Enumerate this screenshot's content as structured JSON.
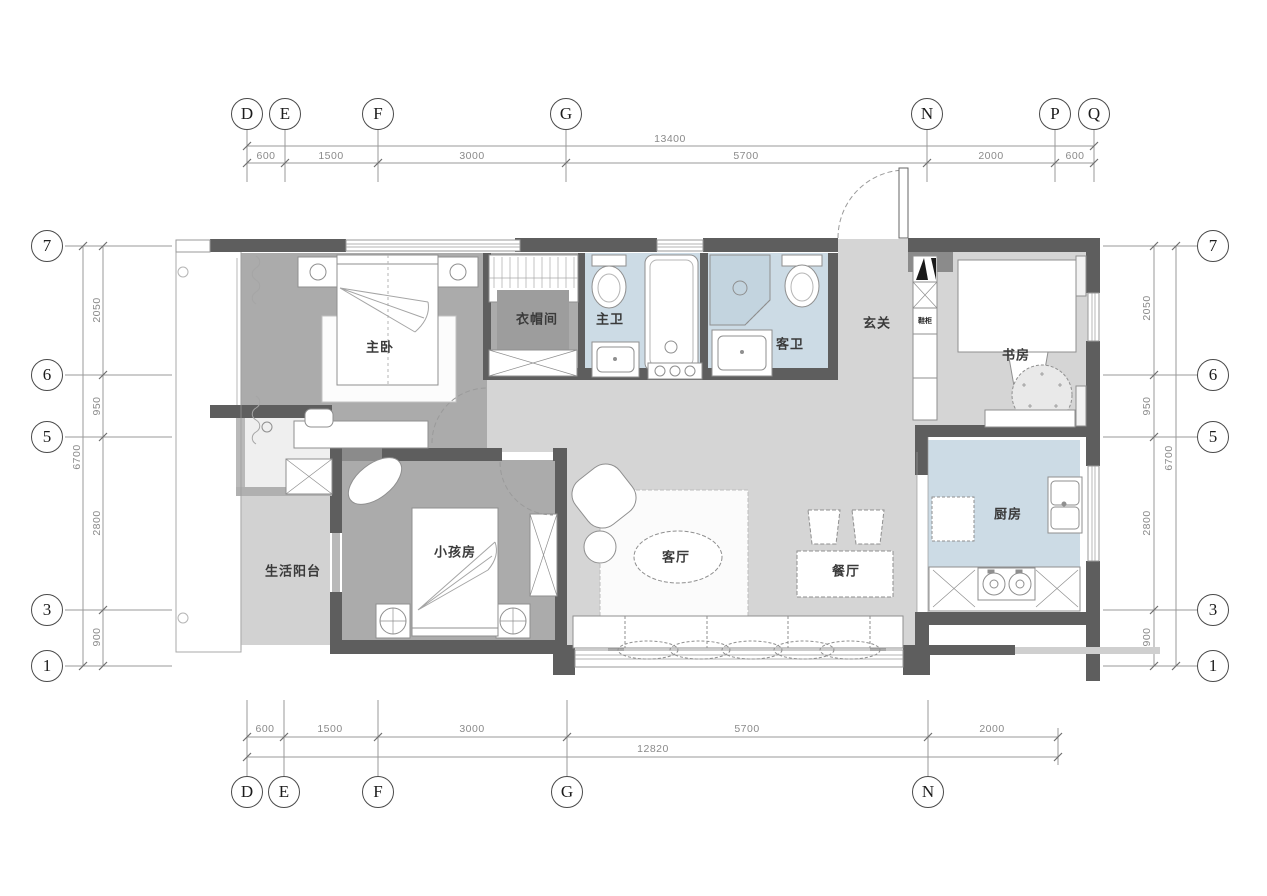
{
  "drawing": {
    "type": "apartment-floor-plan"
  },
  "rooms": [
    {
      "name": "主卧"
    },
    {
      "name": "衣帽间"
    },
    {
      "name": "主卫"
    },
    {
      "name": "客卫"
    },
    {
      "name": "玄关"
    },
    {
      "name": "书房"
    },
    {
      "name": "厨房"
    },
    {
      "name": "餐厅"
    },
    {
      "name": "客厅"
    },
    {
      "name": "小孩房"
    },
    {
      "name": "生活阳台"
    },
    {
      "name": "鞋柜"
    }
  ],
  "axes": {
    "top": [
      "D",
      "E",
      "F",
      "G",
      "N",
      "P",
      "Q"
    ],
    "bottom": [
      "D",
      "E",
      "F",
      "G",
      "N"
    ],
    "left": [
      "7",
      "6",
      "5",
      "3",
      "1"
    ],
    "right": [
      "7",
      "6",
      "5",
      "3",
      "1"
    ]
  },
  "dims": {
    "top": {
      "segments": [
        "600",
        "1500",
        "3000",
        "5700",
        "2000",
        "600"
      ],
      "overall": "13400"
    },
    "bottom": {
      "segments": [
        "600",
        "1500",
        "3000",
        "5700",
        "2000"
      ],
      "overall": "12820"
    },
    "left": {
      "segments": [
        "2050",
        "950",
        "2800",
        "900"
      ],
      "overall": "6700"
    },
    "right": {
      "segments": [
        "2050",
        "950",
        "2800",
        "900"
      ],
      "overall": "6700"
    }
  },
  "colors": {
    "wall": "#5e5e5e",
    "bedroom_floor": "#ababab",
    "hall_floor": "#d5d5d5",
    "wet_floor": "#ccdbe5"
  }
}
